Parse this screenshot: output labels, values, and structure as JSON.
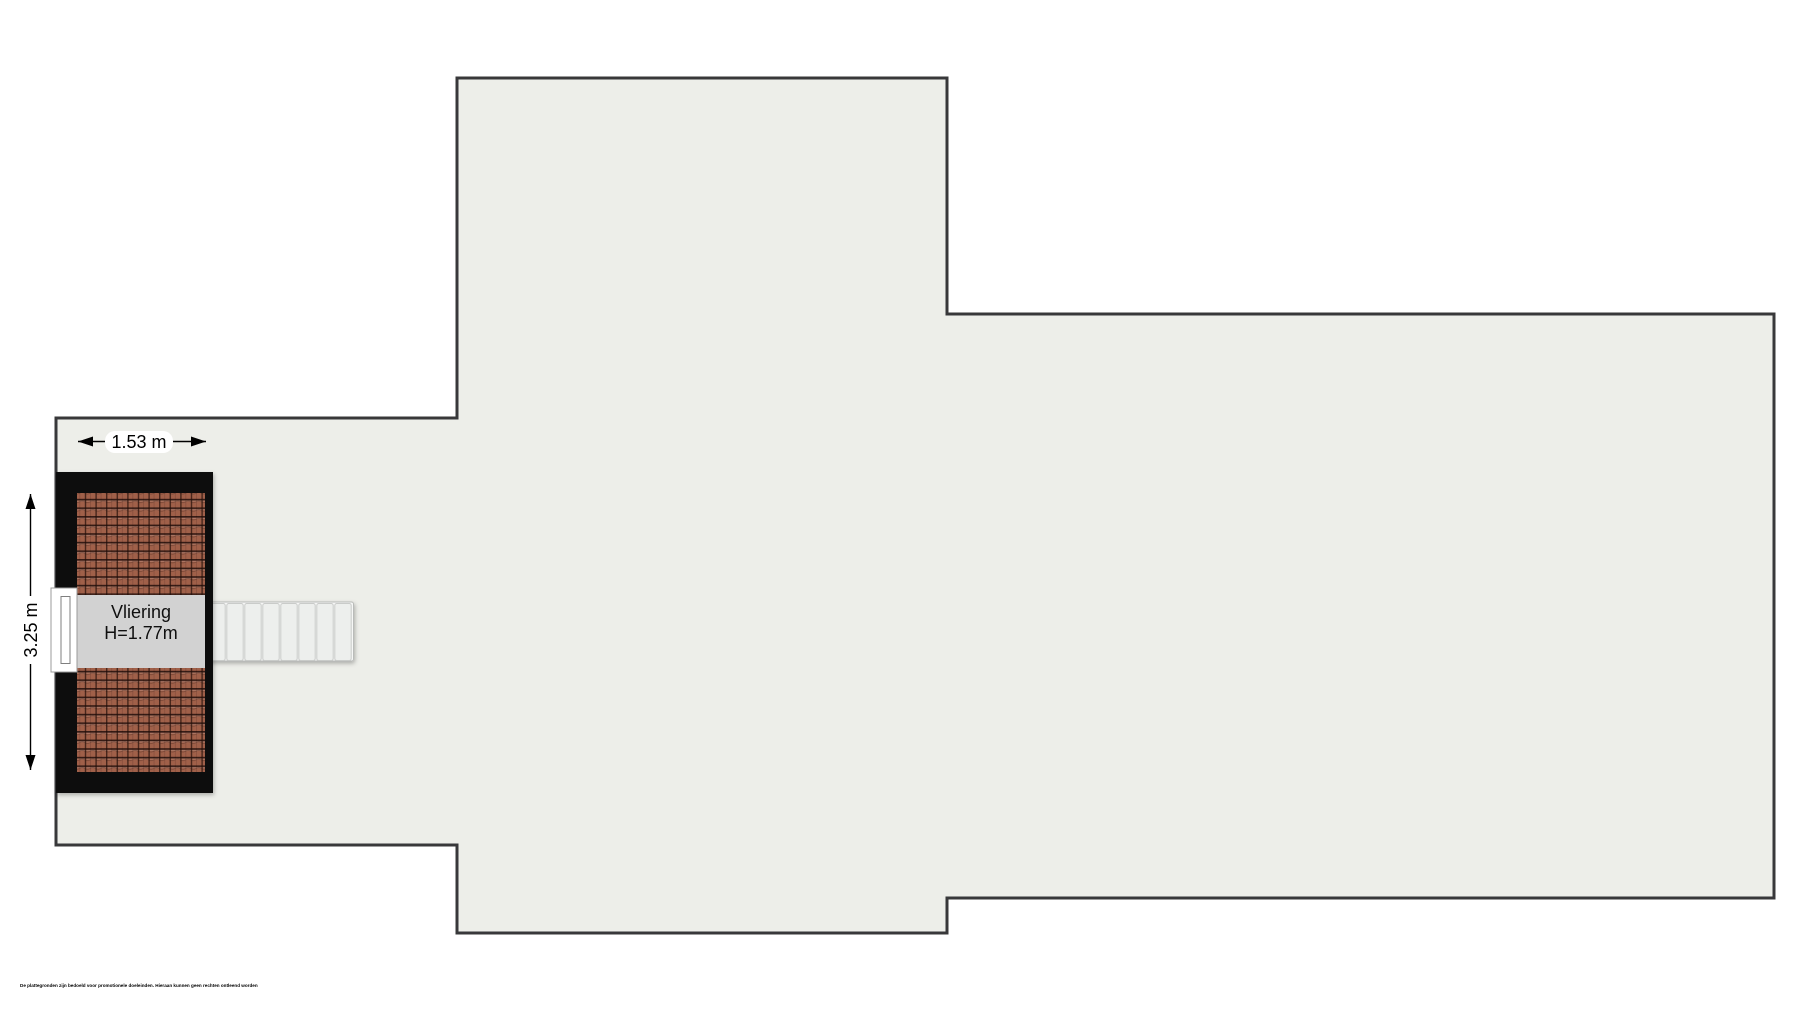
{
  "dimensions": {
    "width_label": "1.53 m",
    "height_label": "3.25 m"
  },
  "room": {
    "name": "Vliering",
    "height_label": "H=1.77m"
  },
  "stairs": {
    "step_count": 8
  },
  "footer": {
    "disclaimer": "De plattegronden zijn bedoeld voor promotionele doeleinden. Hieraan kunnen geen rechten ontleend worden"
  },
  "colors": {
    "plan_fill": "#EDEEE9",
    "plan_outline": "#38383A",
    "wall": "#0B0B0B",
    "room_floor": "#D2D2D2",
    "roof_tile": "#A0604A",
    "stairs_fill": "#EDEFED"
  }
}
